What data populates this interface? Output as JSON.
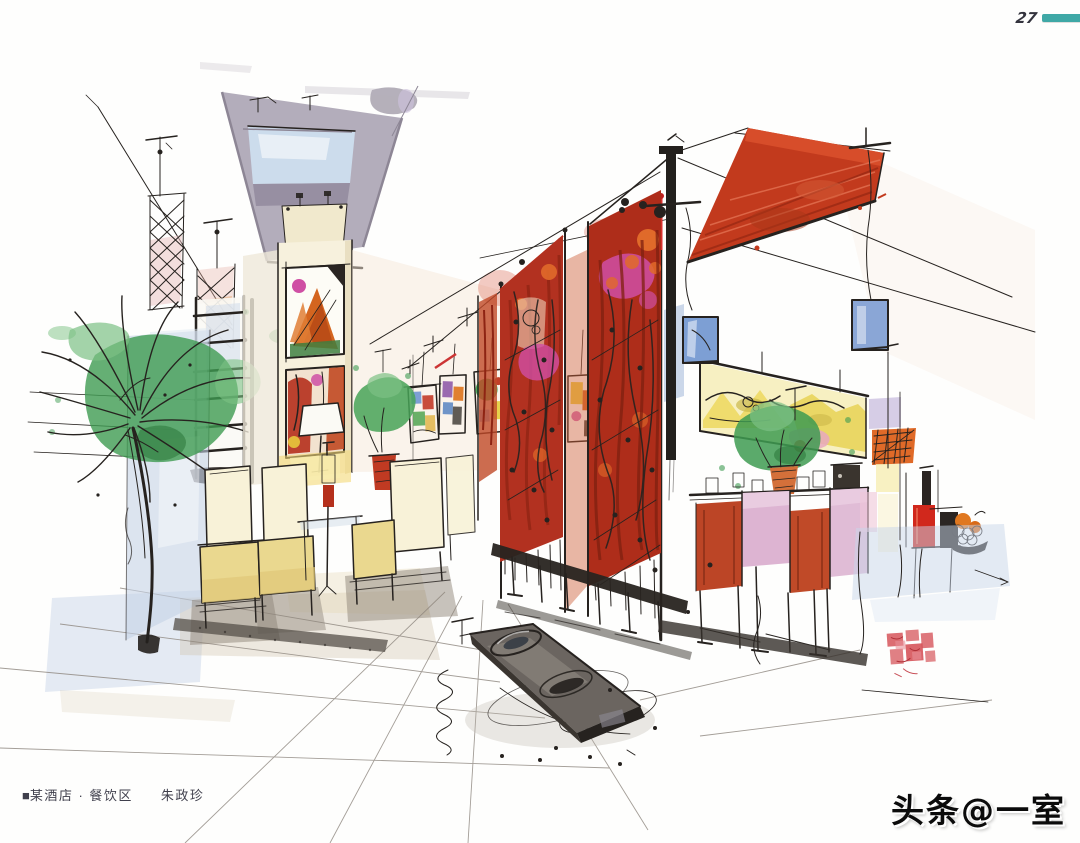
{
  "page": {
    "number": "27"
  },
  "caption": {
    "marker": "■",
    "title": "某酒店 · 餐饮区",
    "artist": "朱政珍"
  },
  "watermark": {
    "text": "头条@一室"
  },
  "artwork": {
    "medium": "hand-drawn marker and watercolor interior rendering",
    "subject": "hotel dining area: corridor ceiling with skylight, red hanging art banners, palm tree, cream dining chairs, bar counter with plants and red canopy",
    "seal": "red artist seal stamp (illegible)"
  },
  "colors": {
    "teal_bar": "#3fa8a6",
    "banner_red": "#b23120",
    "banner_red_dark": "#8e2413",
    "canopy_red": "#c23a1d",
    "magenta": "#cf4fa4",
    "orange_accent": "#e06a2a",
    "palm_green": "#3e9b51",
    "palm_green_light": "#7cc184",
    "chair_cream": "#ead88f",
    "chair_cream_light": "#f8f2d8",
    "counter_pink": "#ddb4d2",
    "stool_red": "#bc4526",
    "ceiling_gray": "#b3adbb",
    "skylight_blue": "#ccdcec",
    "wash_blue": "#c5d2e6",
    "wash_peach": "#f6e7da",
    "ink": "#26221f",
    "seal_red": "#d34a50",
    "caption_text": "#3f3f4c"
  }
}
